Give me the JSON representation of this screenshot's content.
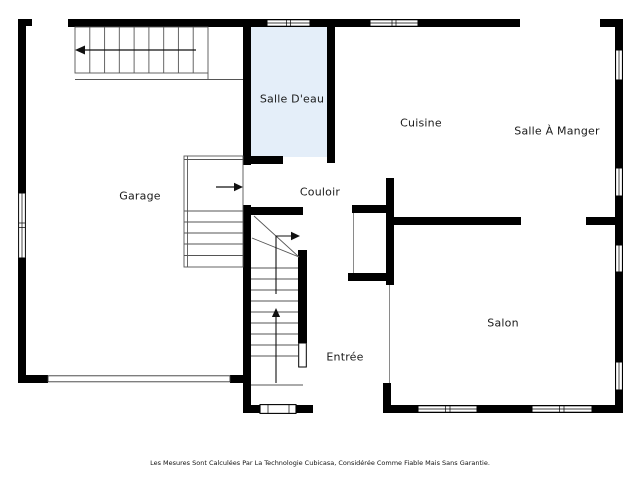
{
  "rooms": {
    "garage": "Garage",
    "salle_deau": "Salle D'eau",
    "cuisine": "Cuisine",
    "salle_a_manger": "Salle À Manger",
    "couloir": "Couloir",
    "salon": "Salon",
    "entree": "Entrée"
  },
  "footer": "Les Mesures Sont Calculées Par La Technologie Cubicasa, Considérée Comme Fiable Mais Sans Garantie.",
  "colors": {
    "wall": "#000000",
    "wet_room_fill": "#e4eef9",
    "background": "#ffffff",
    "stair_line": "#555555",
    "label": "#1a1a1a"
  }
}
